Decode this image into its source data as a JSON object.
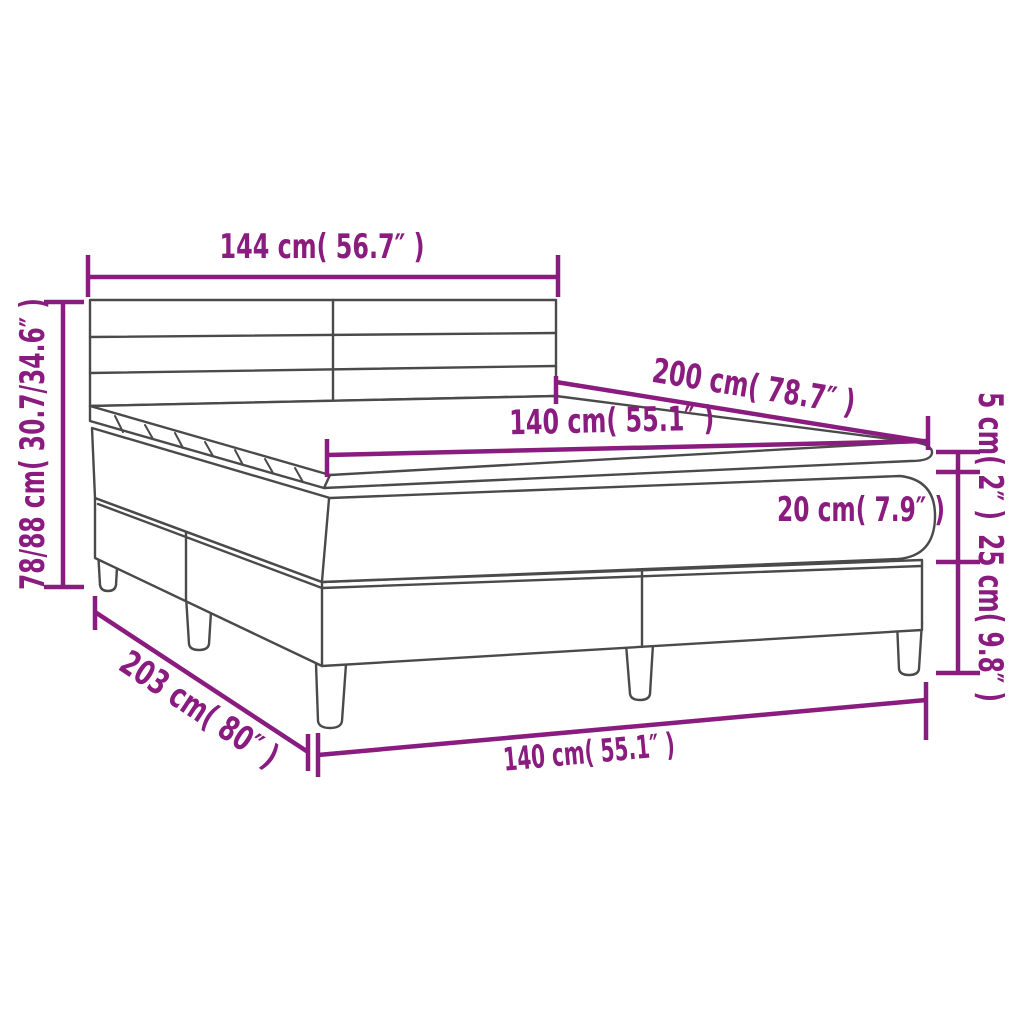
{
  "colors": {
    "dimension": "#8A1B7F",
    "outline": "#4A4A4A",
    "background": "#FFFFFF"
  },
  "diagram": {
    "title": "box spring bed with mattress dimension diagram",
    "labels": {
      "headboard_width": "144 cm( 56.7″ )",
      "total_height": "78/88 cm( 30.7/34.6″ )",
      "bed_length": "200 cm( 78.7″ )",
      "mattress_width": "140 cm( 55.1″ )",
      "topper_height": "5 cm( 2″ )",
      "mattress_height": "20 cm( 7.9″ )",
      "base_height": "25 cm( 9.8″ )",
      "total_length": "203 cm( 80″ )",
      "base_width": "140 cm( 55.1″ )"
    },
    "measurements": [
      {
        "part": "headboard width",
        "cm": "144",
        "inches": "56.7"
      },
      {
        "part": "total height",
        "cm": "78/88",
        "inches": "30.7/34.6"
      },
      {
        "part": "bed length (top)",
        "cm": "200",
        "inches": "78.7"
      },
      {
        "part": "mattress width (top)",
        "cm": "140",
        "inches": "55.1"
      },
      {
        "part": "topper thickness",
        "cm": "5",
        "inches": "2"
      },
      {
        "part": "mattress thickness",
        "cm": "20",
        "inches": "7.9"
      },
      {
        "part": "base height",
        "cm": "25",
        "inches": "9.8"
      },
      {
        "part": "total length",
        "cm": "203",
        "inches": "80"
      },
      {
        "part": "base width (bottom)",
        "cm": "140",
        "inches": "55.1"
      }
    ]
  }
}
